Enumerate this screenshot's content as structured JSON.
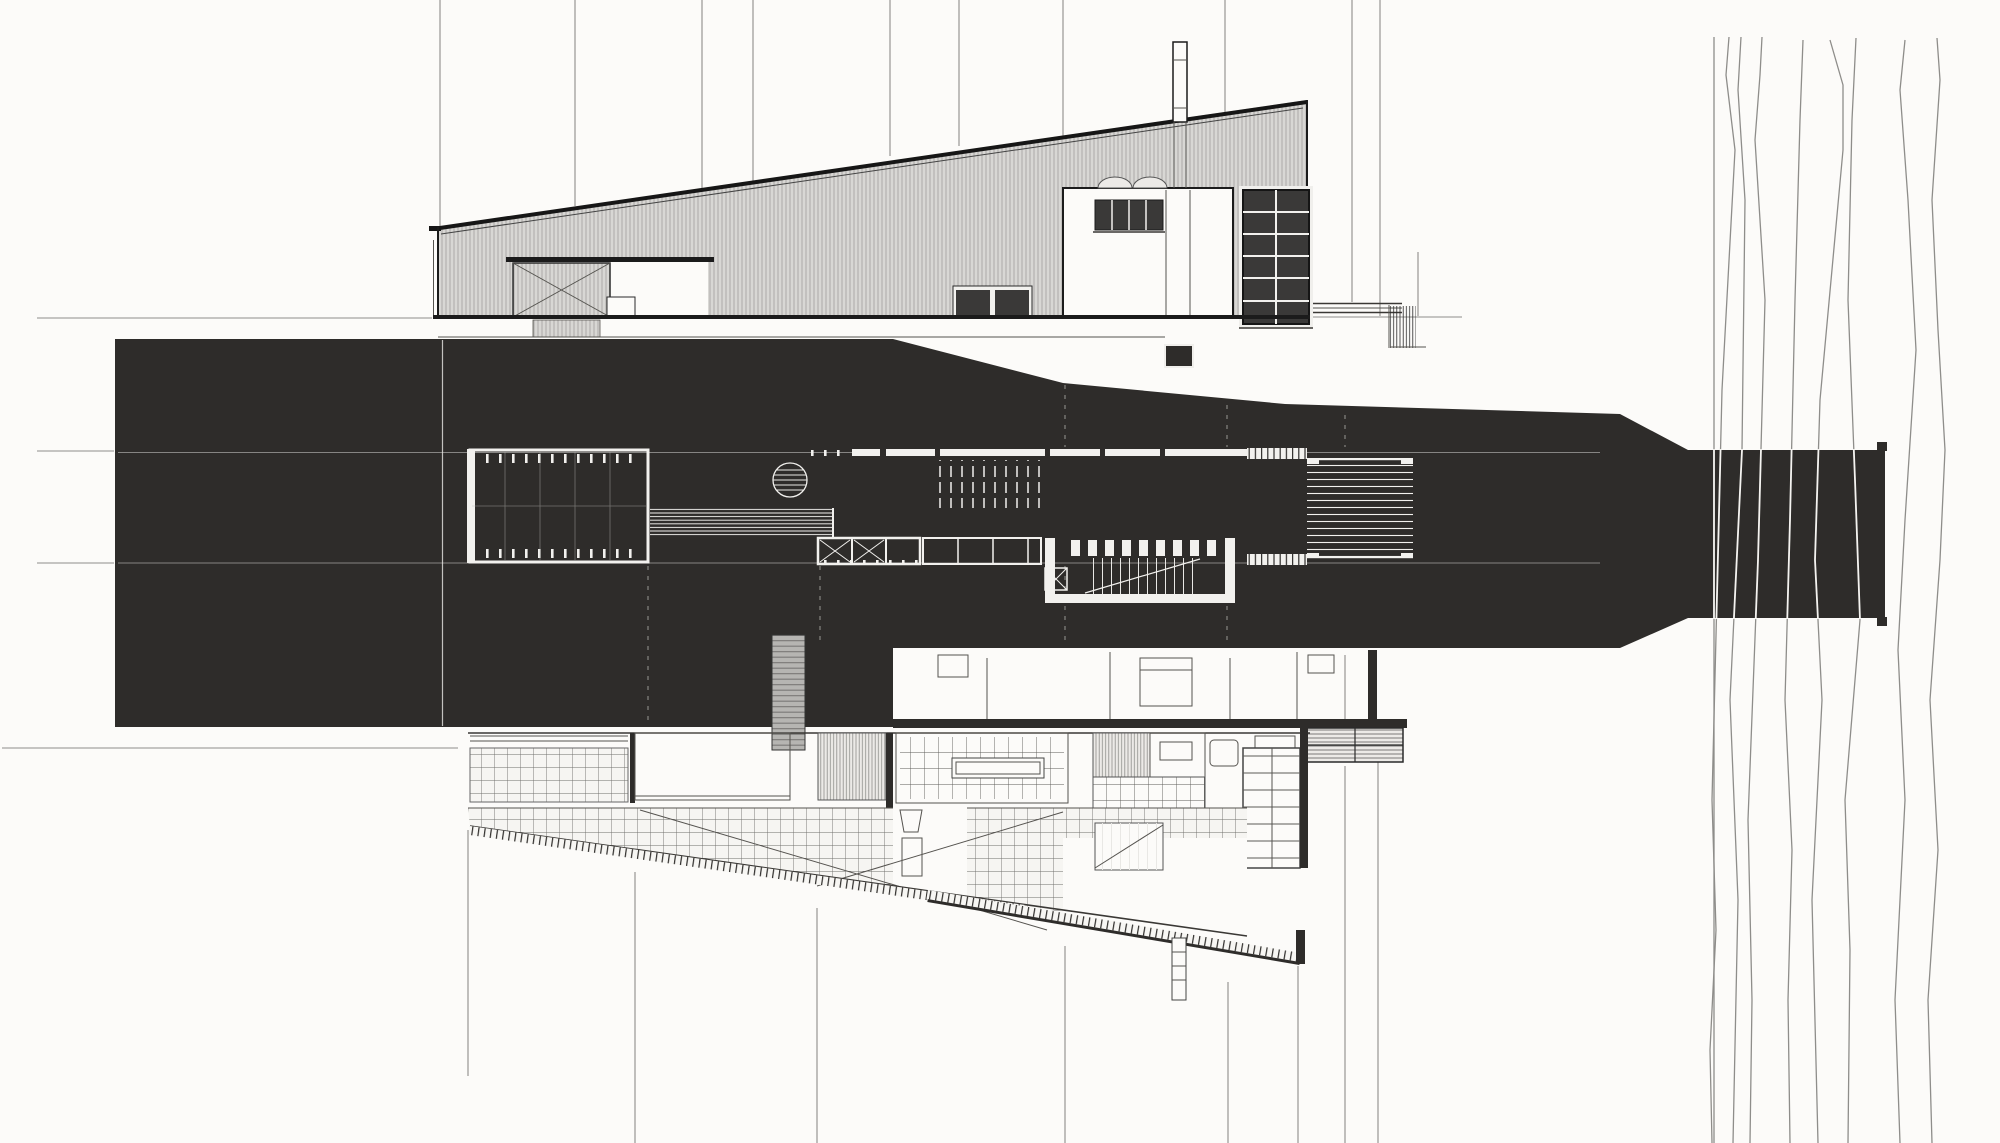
{
  "drawing": {
    "type": "architectural-drawing",
    "technique": "ink plan and elevation, solid poche plan band over white paper",
    "views": {
      "top": "long mono-pitch shed elevation with corrugated cladding, sliding door, clerestory tower, chimney and gridded glazing panel",
      "middle": "solid black plan band with white line interior (courtyard, round table, long bench, stair hatch, sunken stair room, louvered deck) narrowing into a bridge that crosses river contours at right",
      "bottom": "tapered lower wing plan with square paving grid, diagonal braces, kitchen grid, shelving, stairs and hatched retaining edge"
    }
  },
  "colors": {
    "paper": "#fcfbf9",
    "ink": "#1b1b1b",
    "mass": "#2e2c2a",
    "grayline": "#8e8d8a",
    "wdetail": "#f2f1ee",
    "clad": "#d8d7d4",
    "cladstripe": "#a6a5a2",
    "pane": "#3a3938",
    "pavbg": "#f6f5f2",
    "pavline": "#6f6e6b"
  },
  "grid_lines": {
    "vertical": [
      {
        "x": 440,
        "y1": 0,
        "y2": 316
      },
      {
        "x": 575,
        "y1": 0,
        "y2": 206
      },
      {
        "x": 702,
        "y1": 0,
        "y2": 188
      },
      {
        "x": 753,
        "y1": 0,
        "y2": 182
      },
      {
        "x": 890,
        "y1": 0,
        "y2": 156
      },
      {
        "x": 959,
        "y1": 0,
        "y2": 146
      },
      {
        "x": 1063,
        "y1": 0,
        "y2": 188
      },
      {
        "x": 1225,
        "y1": 0,
        "y2": 186
      },
      {
        "x": 1352,
        "y1": 0,
        "y2": 302
      },
      {
        "x": 1380,
        "y1": 0,
        "y2": 316
      },
      {
        "x": 1418,
        "y1": 252,
        "y2": 316
      },
      {
        "x": 468,
        "y1": 830,
        "y2": 1076
      },
      {
        "x": 635,
        "y1": 872,
        "y2": 1143
      },
      {
        "x": 817,
        "y1": 908,
        "y2": 1143
      },
      {
        "x": 1065,
        "y1": 946,
        "y2": 1143
      },
      {
        "x": 1228,
        "y1": 982,
        "y2": 1143
      },
      {
        "x": 1298,
        "y1": 966,
        "y2": 1143
      },
      {
        "x": 1345,
        "y1": 655,
        "y2": 726
      },
      {
        "x": 1345,
        "y1": 766,
        "y2": 1143
      },
      {
        "x": 1378,
        "y1": 762,
        "y2": 1143
      }
    ],
    "horizontal": [
      {
        "y": 318,
        "x1": 37,
        "x2": 432
      },
      {
        "y": 317,
        "x1": 1310,
        "x2": 1462
      },
      {
        "y": 451,
        "x1": 37,
        "x2": 114
      },
      {
        "y": 563,
        "x1": 37,
        "x2": 114
      },
      {
        "y": 748,
        "x1": 2,
        "x2": 458
      }
    ]
  },
  "river": {
    "lines": [
      [
        [
          1714,
          37
        ],
        [
          1714,
          1143
        ]
      ],
      [
        [
          1729,
          37
        ],
        [
          1726,
          75
        ],
        [
          1735,
          150
        ],
        [
          1722,
          390
        ],
        [
          1712,
          800
        ],
        [
          1716,
          930
        ],
        [
          1710,
          1050
        ],
        [
          1712,
          1143
        ]
      ],
      [
        [
          1741,
          37
        ],
        [
          1738,
          90
        ],
        [
          1745,
          200
        ],
        [
          1742,
          450
        ],
        [
          1730,
          700
        ],
        [
          1738,
          900
        ],
        [
          1733,
          1143
        ]
      ],
      [
        [
          1762,
          37
        ],
        [
          1760,
          75
        ],
        [
          1755,
          140
        ],
        [
          1765,
          300
        ],
        [
          1758,
          560
        ],
        [
          1748,
          820
        ],
        [
          1752,
          1000
        ],
        [
          1750,
          1143
        ]
      ],
      [
        [
          1803,
          40
        ],
        [
          1800,
          120
        ],
        [
          1795,
          300
        ],
        [
          1790,
          520
        ],
        [
          1785,
          700
        ],
        [
          1792,
          850
        ],
        [
          1788,
          1000
        ],
        [
          1790,
          1143
        ]
      ],
      [
        [
          1830,
          40
        ],
        [
          1843,
          85
        ],
        [
          1843,
          150
        ],
        [
          1820,
          400
        ],
        [
          1815,
          560
        ],
        [
          1822,
          700
        ],
        [
          1812,
          900
        ],
        [
          1818,
          1143
        ]
      ],
      [
        [
          1856,
          38
        ],
        [
          1852,
          120
        ],
        [
          1848,
          300
        ],
        [
          1855,
          480
        ],
        [
          1860,
          620
        ],
        [
          1845,
          800
        ],
        [
          1850,
          950
        ],
        [
          1848,
          1143
        ]
      ],
      [
        [
          1905,
          40
        ],
        [
          1900,
          90
        ],
        [
          1908,
          200
        ],
        [
          1916,
          350
        ],
        [
          1905,
          520
        ],
        [
          1898,
          650
        ],
        [
          1905,
          800
        ],
        [
          1895,
          1000
        ],
        [
          1900,
          1143
        ]
      ],
      [
        [
          1937,
          38
        ],
        [
          1940,
          80
        ],
        [
          1932,
          200
        ],
        [
          1938,
          330
        ],
        [
          1945,
          450
        ],
        [
          1940,
          560
        ],
        [
          1930,
          700
        ],
        [
          1938,
          850
        ],
        [
          1928,
          1000
        ],
        [
          1932,
          1143
        ]
      ]
    ]
  }
}
